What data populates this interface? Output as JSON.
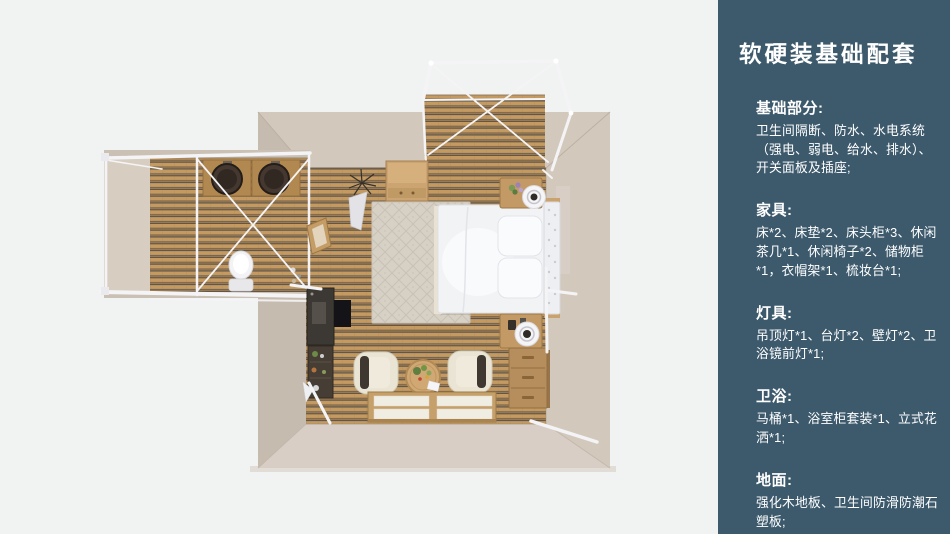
{
  "colors": {
    "background": "#f1f2f2",
    "panel": "#3d5a6d",
    "panel_text": "#ffffff",
    "wall": "#cbc0b4",
    "wall_top": "#d3c8bc",
    "wall_side": "#c6bbaf",
    "wall_front": "#d8cec5",
    "wing_inner": "#d8cdc1",
    "wood": "#c49a60",
    "wood_stripe": "#55504c",
    "frame_white": "#f4f4f6",
    "bed_white": "#f2f3f5",
    "rug": "#d7d0c5",
    "furniture_wood": "#c39a66",
    "dark_furniture": "#3c3833",
    "chair_cream": "#e9e4d3"
  },
  "panel": {
    "title": "软硬装基础配套",
    "sections": [
      {
        "heading": "基础部分:",
        "body": "卫生间隔断、防水、水电系统（强电、弱电、给水、排水）、开关面板及插座;"
      },
      {
        "heading": "家具:",
        "body": "床*2、床垫*2、床头柜*3、休闲茶几*1、休闲椅子*2、储物柜*1，衣帽架*1、梳妆台*1;"
      },
      {
        "heading": "灯具:",
        "body": "吊顶灯*1、台灯*2、壁灯*2、卫浴镜前灯*1;"
      },
      {
        "heading": "卫浴:",
        "body": "马桶*1、浴室柜套装*1、立式花洒*1;"
      },
      {
        "heading": "地面:",
        "body": "强化木地板、卫生间防滑防潮石塑板;"
      }
    ]
  },
  "scene": {
    "type": "top-down-3d-room-render",
    "areas": [
      "bedroom",
      "bathroom-wing",
      "balcony-deck"
    ],
    "furniture": [
      "double-bed",
      "pillows",
      "tufted-headboard",
      "nightstand",
      "table-lamp",
      "dresser-drawers",
      "desk",
      "desk-chair",
      "lounge-chair",
      "coffee-table",
      "floor-platform-mats",
      "patterned-rug",
      "storage-rack",
      "vanity-mirror",
      "wall-cabinet",
      "twin-basins",
      "toilet",
      "plant",
      "teepee-decor",
      "white-tent-frame"
    ]
  }
}
